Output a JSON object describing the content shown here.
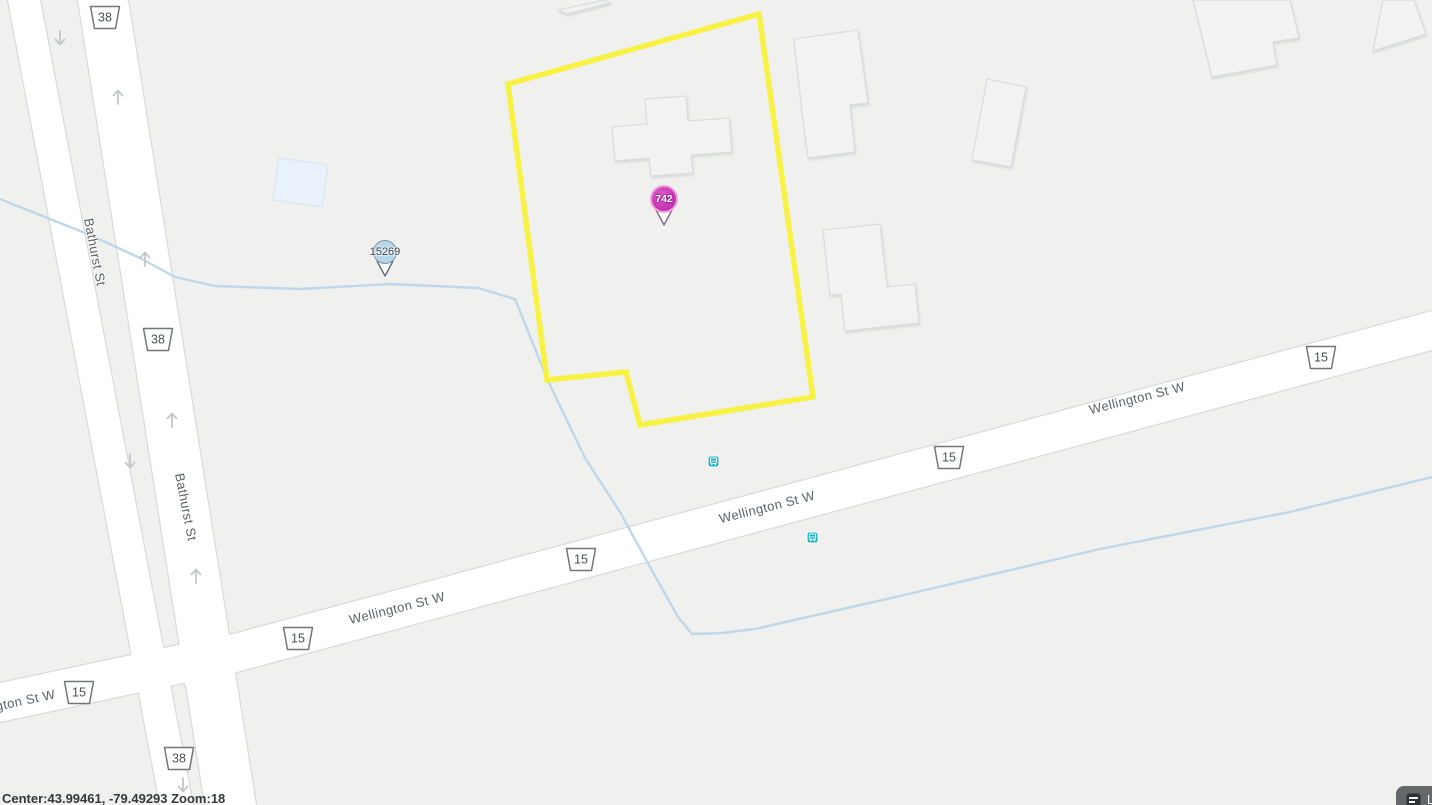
{
  "map": {
    "type": "street-map",
    "street_labels": [
      {
        "text": "Bathurst St"
      },
      {
        "text": "Bathurst St"
      },
      {
        "text": "Wellington St W"
      },
      {
        "text": "Wellington St W"
      },
      {
        "text": "Wellington St W"
      },
      {
        "text": "Wellington St W"
      }
    ],
    "route_shields": [
      {
        "number": "38"
      },
      {
        "number": "38"
      },
      {
        "number": "38"
      },
      {
        "number": "15"
      },
      {
        "number": "15"
      },
      {
        "number": "15"
      },
      {
        "number": "15"
      },
      {
        "number": "15"
      }
    ],
    "markers": [
      {
        "label": "742",
        "type": "property-pin",
        "color": "#c935b5"
      },
      {
        "label": "15269",
        "type": "address-pin",
        "color": "#b5d7ea"
      }
    ],
    "colors": {
      "background": "#f0f1ee",
      "road": "#ffffff",
      "water": "#b8d4e8",
      "parcel_outline": "#f8f13b",
      "transit": "#14b2c6"
    }
  },
  "footer": {
    "status_text": "Center:43.99461, -79.49293 Zoom:18"
  },
  "controls": {
    "labels_button": "Labels"
  }
}
